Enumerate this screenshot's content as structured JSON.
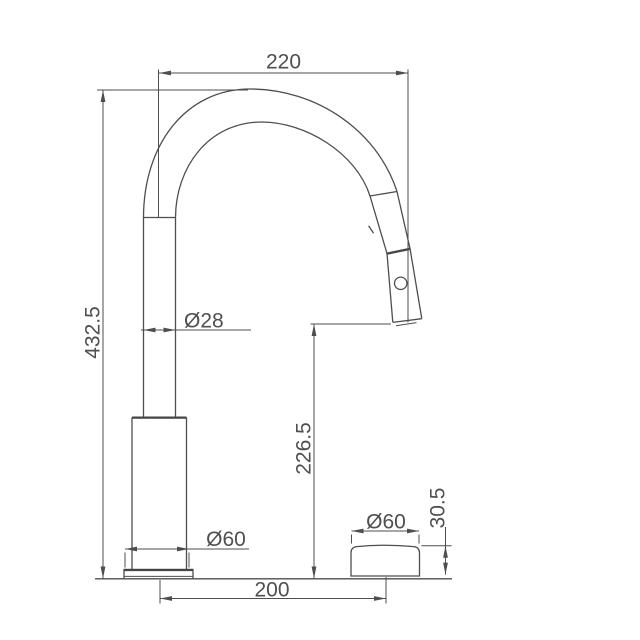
{
  "colors": {
    "background": "#ffffff",
    "line": "#4e4e4e",
    "text": "#4f4f4f"
  },
  "drawing": {
    "kind": "faucet-dimension-drawing",
    "dimensions": {
      "spout_reach": "220",
      "total_height": "432.5",
      "spout_tube_diameter": "Ø28",
      "outlet_height": "226.5",
      "base_diameter": "Ø60",
      "handle_diameter": "Ø60",
      "handle_height": "30.5",
      "base_to_handle_distance": "200"
    }
  }
}
